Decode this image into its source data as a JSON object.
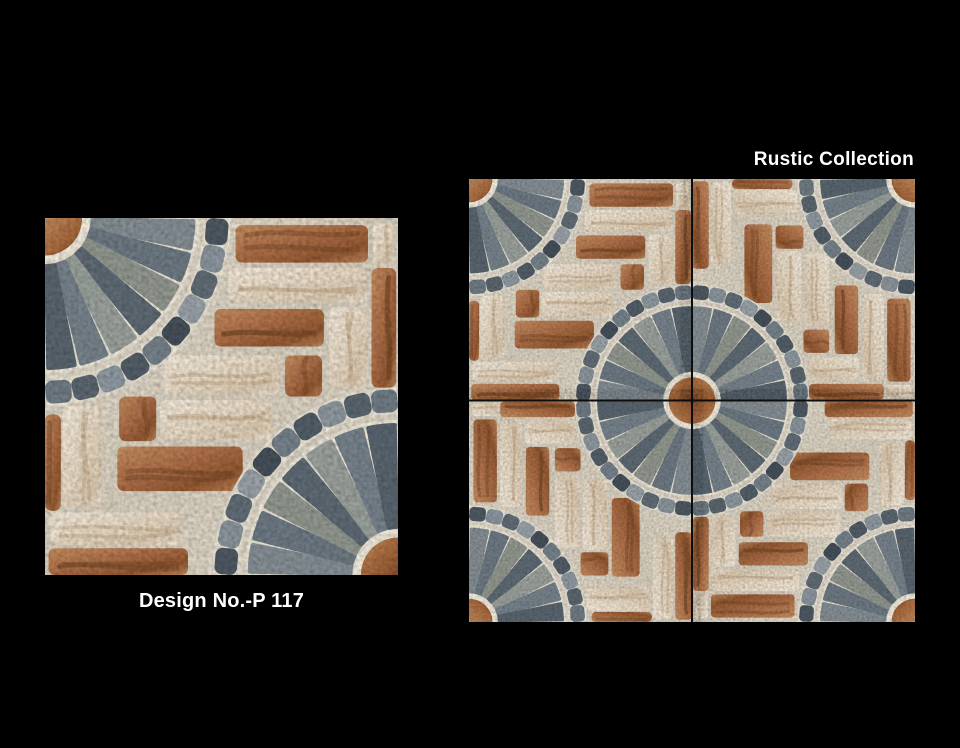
{
  "page": {
    "background_color": "#000000",
    "width": 960,
    "height": 748
  },
  "header": {
    "collection_label": "Rustic Collection",
    "text_color": "#ffffff"
  },
  "single_tile": {
    "design_label": "Design No.-P 117",
    "text_color": "#ffffff"
  },
  "tile_design": {
    "grout_colors": [
      "#e7e0d2",
      "#d8cfbe",
      "#e3dccd"
    ],
    "fan_backing_color": "#ece6d8",
    "cobble_backing_color": "#e9e3d5",
    "brown_brick_colors": [
      "#c58e60",
      "#b0714a",
      "#935831",
      "#bd8559"
    ],
    "cream_brick_colors": [
      "#f3e9da",
      "#e8dac5",
      "#dccab1",
      "#efe3d2"
    ],
    "brown_vein_color": "#6f4424",
    "cream_vein_color": "#c3a989",
    "disc_colors": [
      "#c48d5e",
      "#a86a3e",
      "#864f2d"
    ],
    "disc_radius": 10.5,
    "disc_grout_color": "#f0eadc",
    "wedge_colors": [
      "#848e94",
      "#6d7983",
      "#91978f",
      "#5e6a74",
      "#9aa09b",
      "#76828b",
      "#59656f"
    ],
    "wedges_per_fan": 7,
    "wedge_inner_radius": 13.5,
    "wedge_outer_radius": 42,
    "cobble_colors": [
      "#4e5963",
      "#8b959d",
      "#616c76",
      "#99a2a8",
      "#45505a",
      "#75818a",
      "#535e68",
      "#8e98a0",
      "#5b666f",
      "#6f7b84"
    ],
    "cobbles_per_fan": 10,
    "cobble_ring_radius": 48.8,
    "cobble_size": [
      7.4,
      6.4
    ],
    "fans": [
      {
        "cx": 0,
        "cy": 0,
        "start": 0
      },
      {
        "cx": 100,
        "cy": 100,
        "start": 180
      }
    ],
    "bricks": [
      {
        "x": 54,
        "y": 2,
        "w": 37.5,
        "h": 10.5,
        "k": "b"
      },
      {
        "x": 93,
        "y": 1.5,
        "w": 6,
        "h": 11.5,
        "k": "c"
      },
      {
        "x": 52,
        "y": 14,
        "w": 39,
        "h": 9.5,
        "k": "c"
      },
      {
        "x": 92.5,
        "y": 14,
        "w": 7,
        "h": 33.5,
        "k": "b"
      },
      {
        "x": 48,
        "y": 25.5,
        "w": 31,
        "h": 10.5,
        "k": "b"
      },
      {
        "x": 80.5,
        "y": 25,
        "w": 11,
        "h": 22.5,
        "k": "c"
      },
      {
        "x": 33.5,
        "y": 38.5,
        "w": 33,
        "h": 11,
        "k": "c"
      },
      {
        "x": 68,
        "y": 38.5,
        "w": 10.5,
        "h": 11.5,
        "k": "b"
      },
      {
        "x": 32.5,
        "y": 51,
        "w": 32,
        "h": 11,
        "k": "c"
      },
      {
        "x": 21,
        "y": 50,
        "w": 10.5,
        "h": 12.5,
        "k": "b"
      },
      {
        "x": 20.5,
        "y": 64,
        "w": 35.5,
        "h": 12.5,
        "k": "b"
      },
      {
        "x": 5,
        "y": 52.5,
        "w": 11,
        "h": 28.5,
        "k": "c"
      },
      {
        "x": 0,
        "y": 55,
        "w": 4.5,
        "h": 27,
        "k": "b"
      },
      {
        "x": 1.5,
        "y": 82.5,
        "w": 37,
        "h": 9,
        "k": "c"
      },
      {
        "x": 1,
        "y": 92.5,
        "w": 39.5,
        "h": 7.5,
        "k": "b"
      }
    ],
    "grid": {
      "rotations_deg": [
        0,
        90,
        180,
        270
      ],
      "gap_line_color": "#0d0d0d",
      "gap_line_width": 0.9
    }
  }
}
